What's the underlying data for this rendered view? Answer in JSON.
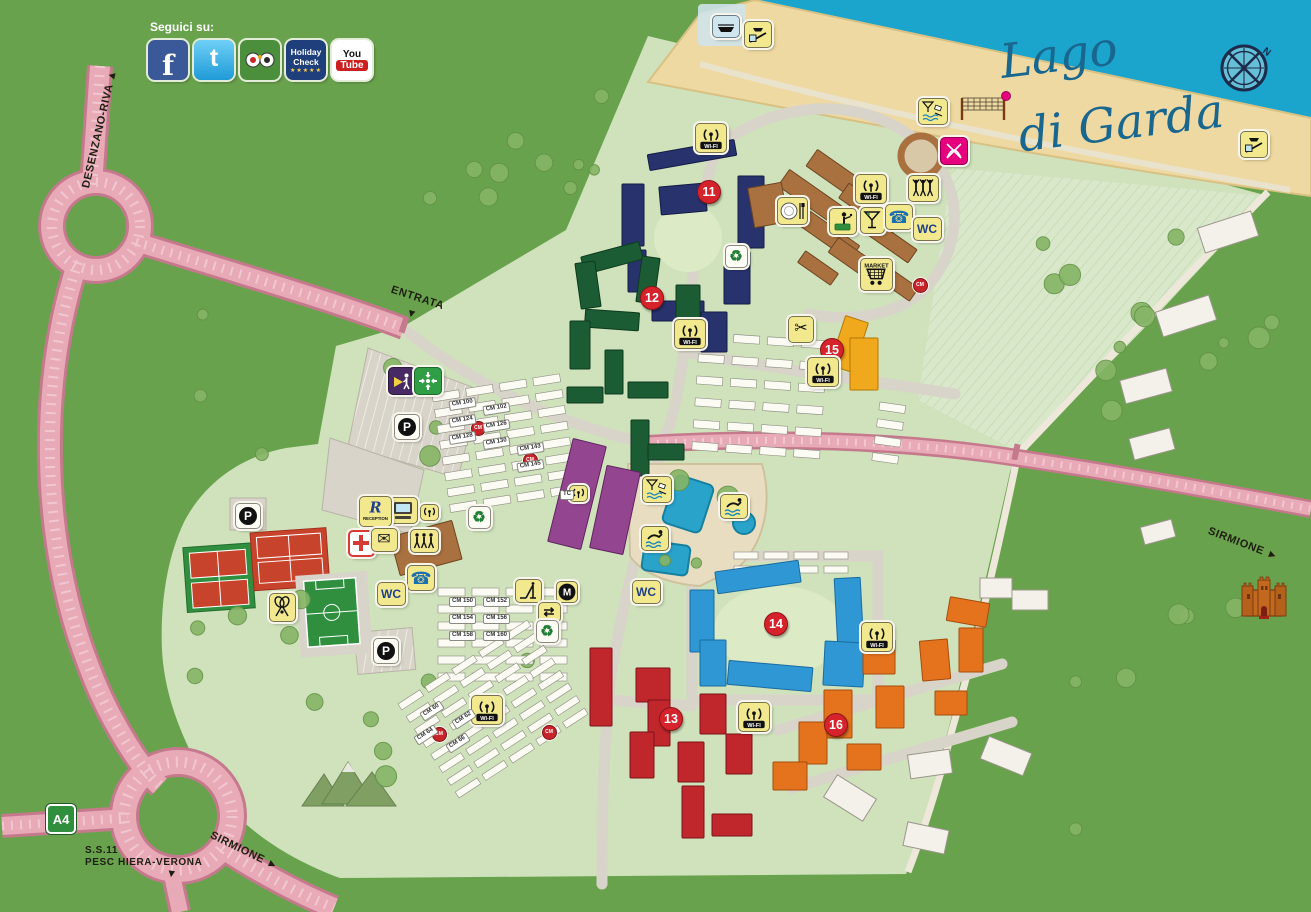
{
  "title": "Holiday village map – Lago di Garda",
  "social": {
    "label": "Seguici su:",
    "icons": [
      {
        "name": "facebook",
        "abbr": "f"
      },
      {
        "name": "twitter",
        "abbr": "t"
      },
      {
        "name": "tripadvisor"
      },
      {
        "name": "holidaycheck",
        "line1": "Holiday",
        "line2": "Check",
        "stars": "★★★★★"
      },
      {
        "name": "youtube",
        "line1": "You",
        "line2": "Tube"
      }
    ]
  },
  "lake": {
    "line1": "Lago",
    "line2": "di Garda"
  },
  "compass": {
    "label": "N"
  },
  "roads": {
    "desenzano": "DESENZANO-RIVA",
    "entrata": "ENTRATA",
    "sirmione_south": "SIRMIONE",
    "ss11_line1": "S.S.11",
    "ss11_line2": "PESC HIERA-VERONA",
    "sirmione_east": "SIRMIONE",
    "a4": "A4"
  },
  "palette": {
    "outer_green": "#69a24d",
    "resort_green": "#cfe2bb",
    "lake_blue": "#1ba4cc",
    "sand": "#eed9a2",
    "road_pink": "#e9aab8",
    "road_pink_edge": "#c4798c",
    "badge_red": "#d6232b",
    "icon_yellow": "#f2e98e"
  },
  "icon_labels": {
    "wifi": "WI-FI",
    "market": "MARKET",
    "reception_r": "R",
    "reception": "RECEPTION"
  },
  "zones": [
    {
      "id": "11",
      "badge": [
        708,
        191
      ],
      "units": "1-38",
      "color": "#28336e",
      "stroke": "#141b45",
      "buildings": [
        [
          692,
          155,
          88,
          16,
          -10
        ],
        [
          633,
          215,
          22,
          62,
          0
        ],
        [
          683,
          199,
          46,
          28,
          -5
        ],
        [
          637,
          271,
          18,
          42,
          0
        ],
        [
          678,
          311,
          52,
          20,
          0
        ],
        [
          714,
          332,
          26,
          40,
          0
        ],
        [
          751,
          212,
          26,
          72,
          0
        ],
        [
          737,
          278,
          26,
          52,
          0
        ]
      ]
    },
    {
      "id": "12",
      "badge": [
        651,
        297
      ],
      "units": "1-55",
      "color": "#1c5c34",
      "stroke": "#0d3a1e",
      "buildings": [
        [
          612,
          258,
          60,
          18,
          -15
        ],
        [
          588,
          285,
          20,
          46,
          -8
        ],
        [
          648,
          280,
          18,
          46,
          8
        ],
        [
          688,
          316,
          24,
          62,
          0
        ],
        [
          612,
          320,
          54,
          18,
          4
        ],
        [
          580,
          345,
          20,
          48,
          0
        ],
        [
          614,
          372,
          18,
          44,
          0
        ],
        [
          648,
          390,
          40,
          16,
          0
        ],
        [
          640,
          448,
          18,
          56,
          0
        ],
        [
          666,
          452,
          36,
          16,
          0
        ],
        [
          585,
          395,
          36,
          16,
          0
        ]
      ]
    },
    {
      "id": "13",
      "badge": [
        670,
        718
      ],
      "units": "1-48",
      "color": "#c0272c",
      "stroke": "#7e1317",
      "buildings": [
        [
          601,
          687,
          22,
          78,
          0
        ],
        [
          653,
          685,
          34,
          34,
          0
        ],
        [
          659,
          723,
          22,
          46,
          0
        ],
        [
          642,
          755,
          24,
          46,
          0
        ],
        [
          691,
          762,
          26,
          40,
          0
        ],
        [
          693,
          812,
          22,
          52,
          0
        ],
        [
          732,
          825,
          40,
          22,
          0
        ],
        [
          713,
          714,
          26,
          40,
          0
        ],
        [
          739,
          754,
          26,
          40,
          0
        ]
      ]
    },
    {
      "id": "14",
      "badge": [
        775,
        623
      ],
      "units": "1-59",
      "color": "#2f97d3",
      "stroke": "#1a6ca0",
      "buildings": [
        [
          758,
          577,
          84,
          22,
          -8
        ],
        [
          702,
          621,
          24,
          62,
          0
        ],
        [
          713,
          663,
          26,
          46,
          0
        ],
        [
          770,
          676,
          84,
          24,
          5
        ],
        [
          849,
          613,
          26,
          70,
          -3
        ],
        [
          844,
          664,
          40,
          44,
          3
        ]
      ]
    },
    {
      "id": "15",
      "badge": [
        831,
        349
      ],
      "units": "1-18",
      "color": "#f0a81c",
      "stroke": "#b57708",
      "buildings": [
        [
          849,
          344,
          24,
          52,
          18
        ],
        [
          864,
          364,
          28,
          52,
          0
        ]
      ]
    },
    {
      "id": "16",
      "badge": [
        835,
        724
      ],
      "units": "1-70",
      "color": "#e5731d",
      "stroke": "#a54c0d",
      "buildings": [
        [
          968,
          612,
          40,
          24,
          10
        ],
        [
          971,
          650,
          24,
          44,
          0
        ],
        [
          935,
          660,
          28,
          40,
          -5
        ],
        [
          951,
          703,
          32,
          24,
          0
        ],
        [
          879,
          657,
          32,
          34,
          0
        ],
        [
          890,
          707,
          28,
          42,
          0
        ],
        [
          838,
          714,
          28,
          48,
          0
        ],
        [
          864,
          757,
          34,
          26,
          0
        ],
        [
          813,
          743,
          28,
          42,
          0
        ],
        [
          790,
          776,
          34,
          28,
          0
        ]
      ]
    },
    {
      "id": "mobile-homes",
      "badge": null,
      "units": "11-37",
      "color": "#93458f",
      "stroke": "#5f2460",
      "buildings": [
        [
          577,
          494,
          34,
          106,
          14
        ],
        [
          615,
          510,
          34,
          84,
          12
        ]
      ]
    },
    {
      "id": "facilities",
      "badge": null,
      "units": "",
      "color": "#a9713f",
      "stroke": "#6f4522",
      "buildings": [
        [
          810,
          196,
          64,
          20,
          35
        ],
        [
          838,
          176,
          64,
          20,
          35
        ],
        [
          866,
          206,
          54,
          18,
          35
        ],
        [
          830,
          236,
          60,
          18,
          35
        ],
        [
          858,
          262,
          60,
          18,
          35
        ],
        [
          892,
          242,
          50,
          16,
          35
        ],
        [
          818,
          268,
          40,
          14,
          35
        ],
        [
          896,
          282,
          44,
          16,
          35
        ],
        [
          768,
          205,
          34,
          40,
          -10
        ],
        [
          426,
          548,
          64,
          40,
          -15
        ]
      ]
    }
  ],
  "outer_buildings": [
    [
      1228,
      232,
      56,
      26,
      -18
    ],
    [
      1186,
      316,
      56,
      26,
      -18
    ],
    [
      1146,
      386,
      48,
      24,
      -15
    ],
    [
      1152,
      444,
      42,
      22,
      -15
    ],
    [
      1158,
      532,
      32,
      18,
      -15
    ],
    [
      996,
      588,
      32,
      20,
      0
    ],
    [
      1030,
      600,
      36,
      20,
      0
    ],
    [
      1006,
      756,
      46,
      24,
      22
    ],
    [
      930,
      764,
      42,
      24,
      -8
    ],
    [
      850,
      798,
      46,
      26,
      32
    ],
    [
      926,
      838,
      42,
      24,
      12
    ]
  ],
  "icons": [
    {
      "t": "boat",
      "x": 725,
      "y": 25,
      "v": "blue"
    },
    {
      "t": "slipway",
      "x": 757,
      "y": 33
    },
    {
      "t": "beachbar",
      "x": 932,
      "y": 110
    },
    {
      "t": "windsurf",
      "x": 953,
      "y": 150,
      "v": "pink"
    },
    {
      "t": "wifi",
      "x": 710,
      "y": 137
    },
    {
      "t": "restaurant",
      "x": 791,
      "y": 210
    },
    {
      "t": "wifi",
      "x": 870,
      "y": 188
    },
    {
      "t": "entertainment",
      "x": 922,
      "y": 187
    },
    {
      "t": "waiter",
      "x": 842,
      "y": 220
    },
    {
      "t": "cocktail",
      "x": 871,
      "y": 219
    },
    {
      "t": "phone",
      "x": 898,
      "y": 216
    },
    {
      "t": "wc",
      "x": 926,
      "y": 228,
      "text": "WC"
    },
    {
      "t": "market",
      "x": 875,
      "y": 273
    },
    {
      "t": "recycle",
      "x": 735,
      "y": 255,
      "v": "white"
    },
    {
      "t": "scissors",
      "x": 800,
      "y": 328
    },
    {
      "t": "wifi",
      "x": 822,
      "y": 371
    },
    {
      "t": "wifi",
      "x": 689,
      "y": 333
    },
    {
      "t": "security",
      "x": 401,
      "y": 380,
      "v": "purple"
    },
    {
      "t": "assembly",
      "x": 427,
      "y": 380,
      "v": "green"
    },
    {
      "t": "parking",
      "x": 406,
      "y": 426,
      "v": "white",
      "text": "P"
    },
    {
      "t": "parking",
      "x": 247,
      "y": 515,
      "v": "white",
      "text": "P"
    },
    {
      "t": "internet",
      "x": 402,
      "y": 509
    },
    {
      "t": "reception",
      "x": 374,
      "y": 510
    },
    {
      "t": "wifi_s",
      "x": 428,
      "y": 511
    },
    {
      "t": "firstaid",
      "x": 359,
      "y": 541,
      "v": "red"
    },
    {
      "t": "mail",
      "x": 383,
      "y": 539
    },
    {
      "t": "miniclub",
      "x": 423,
      "y": 540
    },
    {
      "t": "phone",
      "x": 420,
      "y": 577
    },
    {
      "t": "wc",
      "x": 390,
      "y": 593,
      "text": "WC"
    },
    {
      "t": "tennis",
      "x": 281,
      "y": 606
    },
    {
      "t": "recycle",
      "x": 478,
      "y": 516,
      "v": "white"
    },
    {
      "t": "wifi_s",
      "x": 577,
      "y": 492
    },
    {
      "t": "poolbar",
      "x": 656,
      "y": 488
    },
    {
      "t": "swimmer",
      "x": 733,
      "y": 505
    },
    {
      "t": "swimmer",
      "x": 654,
      "y": 537
    },
    {
      "t": "wc",
      "x": 645,
      "y": 591,
      "text": "WC"
    },
    {
      "t": "playground",
      "x": 527,
      "y": 590
    },
    {
      "t": "minigolf",
      "x": 566,
      "y": 591,
      "text": "M"
    },
    {
      "t": "exchange",
      "x": 548,
      "y": 611,
      "text": "⇄"
    },
    {
      "t": "recycle",
      "x": 546,
      "y": 630,
      "v": "white"
    },
    {
      "t": "parking",
      "x": 385,
      "y": 650,
      "v": "white",
      "text": "P"
    },
    {
      "t": "wifi",
      "x": 486,
      "y": 709
    },
    {
      "t": "wifi",
      "x": 753,
      "y": 716
    },
    {
      "t": "wifi",
      "x": 876,
      "y": 636
    },
    {
      "t": "slipway",
      "x": 1253,
      "y": 143
    },
    {
      "t": "castle",
      "x": 1264,
      "y": 598,
      "v": "free"
    },
    {
      "t": "cm",
      "x": 477,
      "y": 427,
      "text": "CM"
    },
    {
      "t": "cm",
      "x": 529,
      "y": 459,
      "text": "CM"
    },
    {
      "t": "cm",
      "x": 919,
      "y": 284,
      "text": "CM"
    },
    {
      "t": "cm",
      "x": 438,
      "y": 733,
      "text": "CM"
    },
    {
      "t": "cm",
      "x": 548,
      "y": 731,
      "text": "CM"
    }
  ],
  "pitch_areas": [
    {
      "x": 432,
      "y": 394,
      "cols": 4,
      "rows": 8,
      "w": 27,
      "h": 8,
      "gx": 34,
      "gy": 16,
      "rot": -9
    },
    {
      "x": 700,
      "y": 332,
      "cols": 4,
      "rows": 6,
      "w": 26,
      "h": 8,
      "gx": 34,
      "gy": 22,
      "rot": 4
    },
    {
      "x": 880,
      "y": 402,
      "cols": 1,
      "rows": 4,
      "w": 26,
      "h": 8,
      "gx": 30,
      "gy": 17,
      "rot": 8
    },
    {
      "x": 438,
      "y": 588,
      "cols": 4,
      "rows": 6,
      "w": 27,
      "h": 8,
      "gx": 34,
      "gy": 17,
      "rot": 0
    },
    {
      "x": 398,
      "y": 704,
      "cols": 5,
      "rows": 8,
      "w": 26,
      "h": 7,
      "gx": 32,
      "gy": 15,
      "rot": -33
    },
    {
      "x": 734,
      "y": 552,
      "cols": 4,
      "rows": 2,
      "w": 24,
      "h": 7,
      "gx": 30,
      "gy": 14,
      "rot": 0
    }
  ],
  "pitch_labels": [
    {
      "text": "CM 100",
      "x": 449,
      "y": 399,
      "rot": -9
    },
    {
      "text": "CM 102",
      "x": 483,
      "y": 404,
      "rot": -9
    },
    {
      "text": "CM 124",
      "x": 449,
      "y": 416,
      "rot": -9
    },
    {
      "text": "CM 126",
      "x": 483,
      "y": 421,
      "rot": -9
    },
    {
      "text": "CM 128",
      "x": 449,
      "y": 433,
      "rot": -9
    },
    {
      "text": "CM 130",
      "x": 483,
      "y": 438,
      "rot": -9
    },
    {
      "text": "CM 143",
      "x": 517,
      "y": 444,
      "rot": -9
    },
    {
      "text": "CM 145",
      "x": 517,
      "y": 461,
      "rot": -9
    },
    {
      "text": "CM 150",
      "x": 449,
      "y": 597,
      "rot": 0
    },
    {
      "text": "CM 152",
      "x": 483,
      "y": 597,
      "rot": 0
    },
    {
      "text": "CM 154",
      "x": 449,
      "y": 614,
      "rot": 0
    },
    {
      "text": "CM 156",
      "x": 483,
      "y": 614,
      "rot": 0
    },
    {
      "text": "CM 158",
      "x": 449,
      "y": 631,
      "rot": 0
    },
    {
      "text": "CM 160",
      "x": 483,
      "y": 631,
      "rot": 0
    },
    {
      "text": "CM 60",
      "x": 420,
      "y": 706,
      "rot": -33
    },
    {
      "text": "CM 62",
      "x": 452,
      "y": 714,
      "rot": -33
    },
    {
      "text": "CM 64",
      "x": 414,
      "y": 730,
      "rot": -33
    },
    {
      "text": "CM 66",
      "x": 446,
      "y": 738,
      "rot": -33
    },
    {
      "text": "TC",
      "x": 560,
      "y": 490,
      "rot": 0
    }
  ]
}
